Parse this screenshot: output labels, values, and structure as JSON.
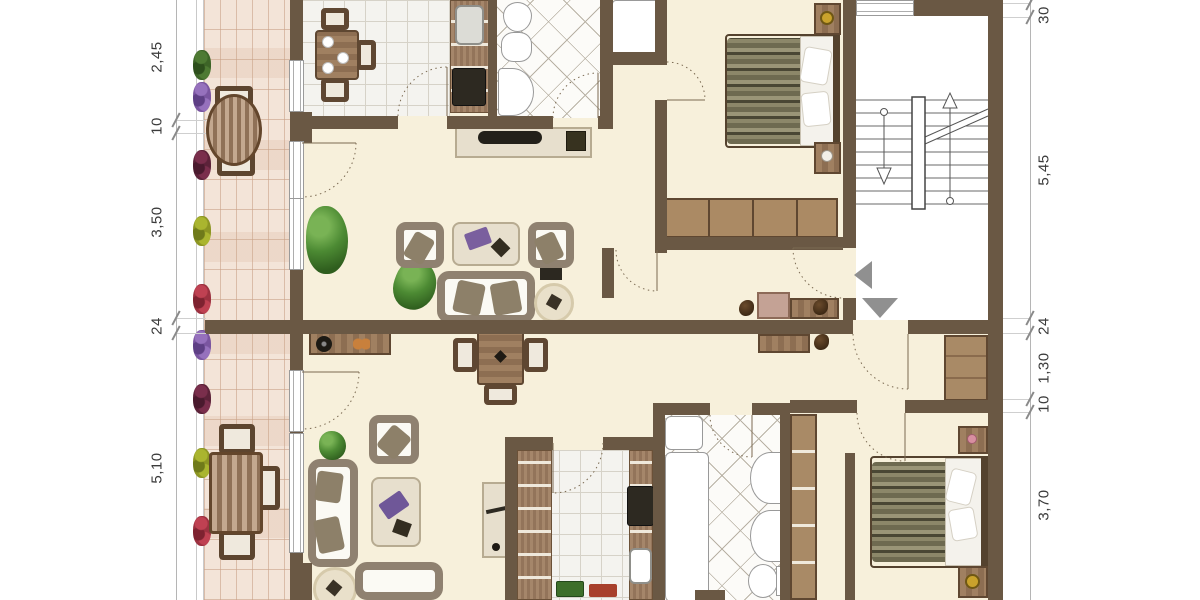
{
  "dimensions": {
    "left": [
      "2,45",
      "10",
      "3,50",
      "24",
      "5,10"
    ],
    "right": [
      "30",
      "5,45",
      "24",
      "1,30",
      "10",
      "3,70"
    ]
  },
  "colors": {
    "wall": "#6a5844",
    "floor": "#f7f0db",
    "stairwell_floor": "#ffffff",
    "balcony_brick": "#f3e4d8",
    "brick_joint": "#c9a288",
    "kitchen_tile": "#f4f3ef",
    "bath_tile": "#fcfbf8",
    "wood_furniture": "#8d6e52",
    "pale_furniture": "#e7dfcd",
    "upholstery_frame": "#8f8170",
    "bed_stripe_dark": "#4a4734",
    "bed_stripe_light": "#9a9577",
    "plant_green": "#4c8a33",
    "entry_arrow_gray": "#909090",
    "dimension_text": "#3b3b3b"
  }
}
